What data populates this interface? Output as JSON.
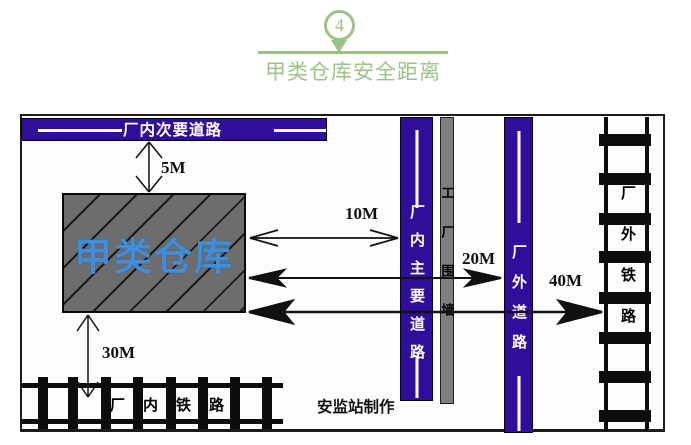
{
  "header": {
    "badge": "4",
    "title": "甲类仓库安全距离"
  },
  "diagram": {
    "secondary_road_label": "厂内次要道路",
    "main_road_label": "厂内主要道路",
    "factory_wall_label": "工厂围墙",
    "outside_road_label": "厂外道路",
    "warehouse_label": "甲类仓库",
    "inside_railway_label": "厂内铁路",
    "outside_railway_label": "厂外铁路",
    "distances": {
      "secondary_road": "5M",
      "main_road": "10M",
      "outside_road": "20M",
      "outside_railway": "40M",
      "inside_railway": "30M"
    },
    "credit": "安监站制作"
  },
  "colors": {
    "road_purple": "#300e9c",
    "accent_green": "#9cc386",
    "warehouse_text_blue": "#3e8ede",
    "warehouse_gray": "#6d6d6d",
    "wall_gray": "#7f7f7f"
  }
}
